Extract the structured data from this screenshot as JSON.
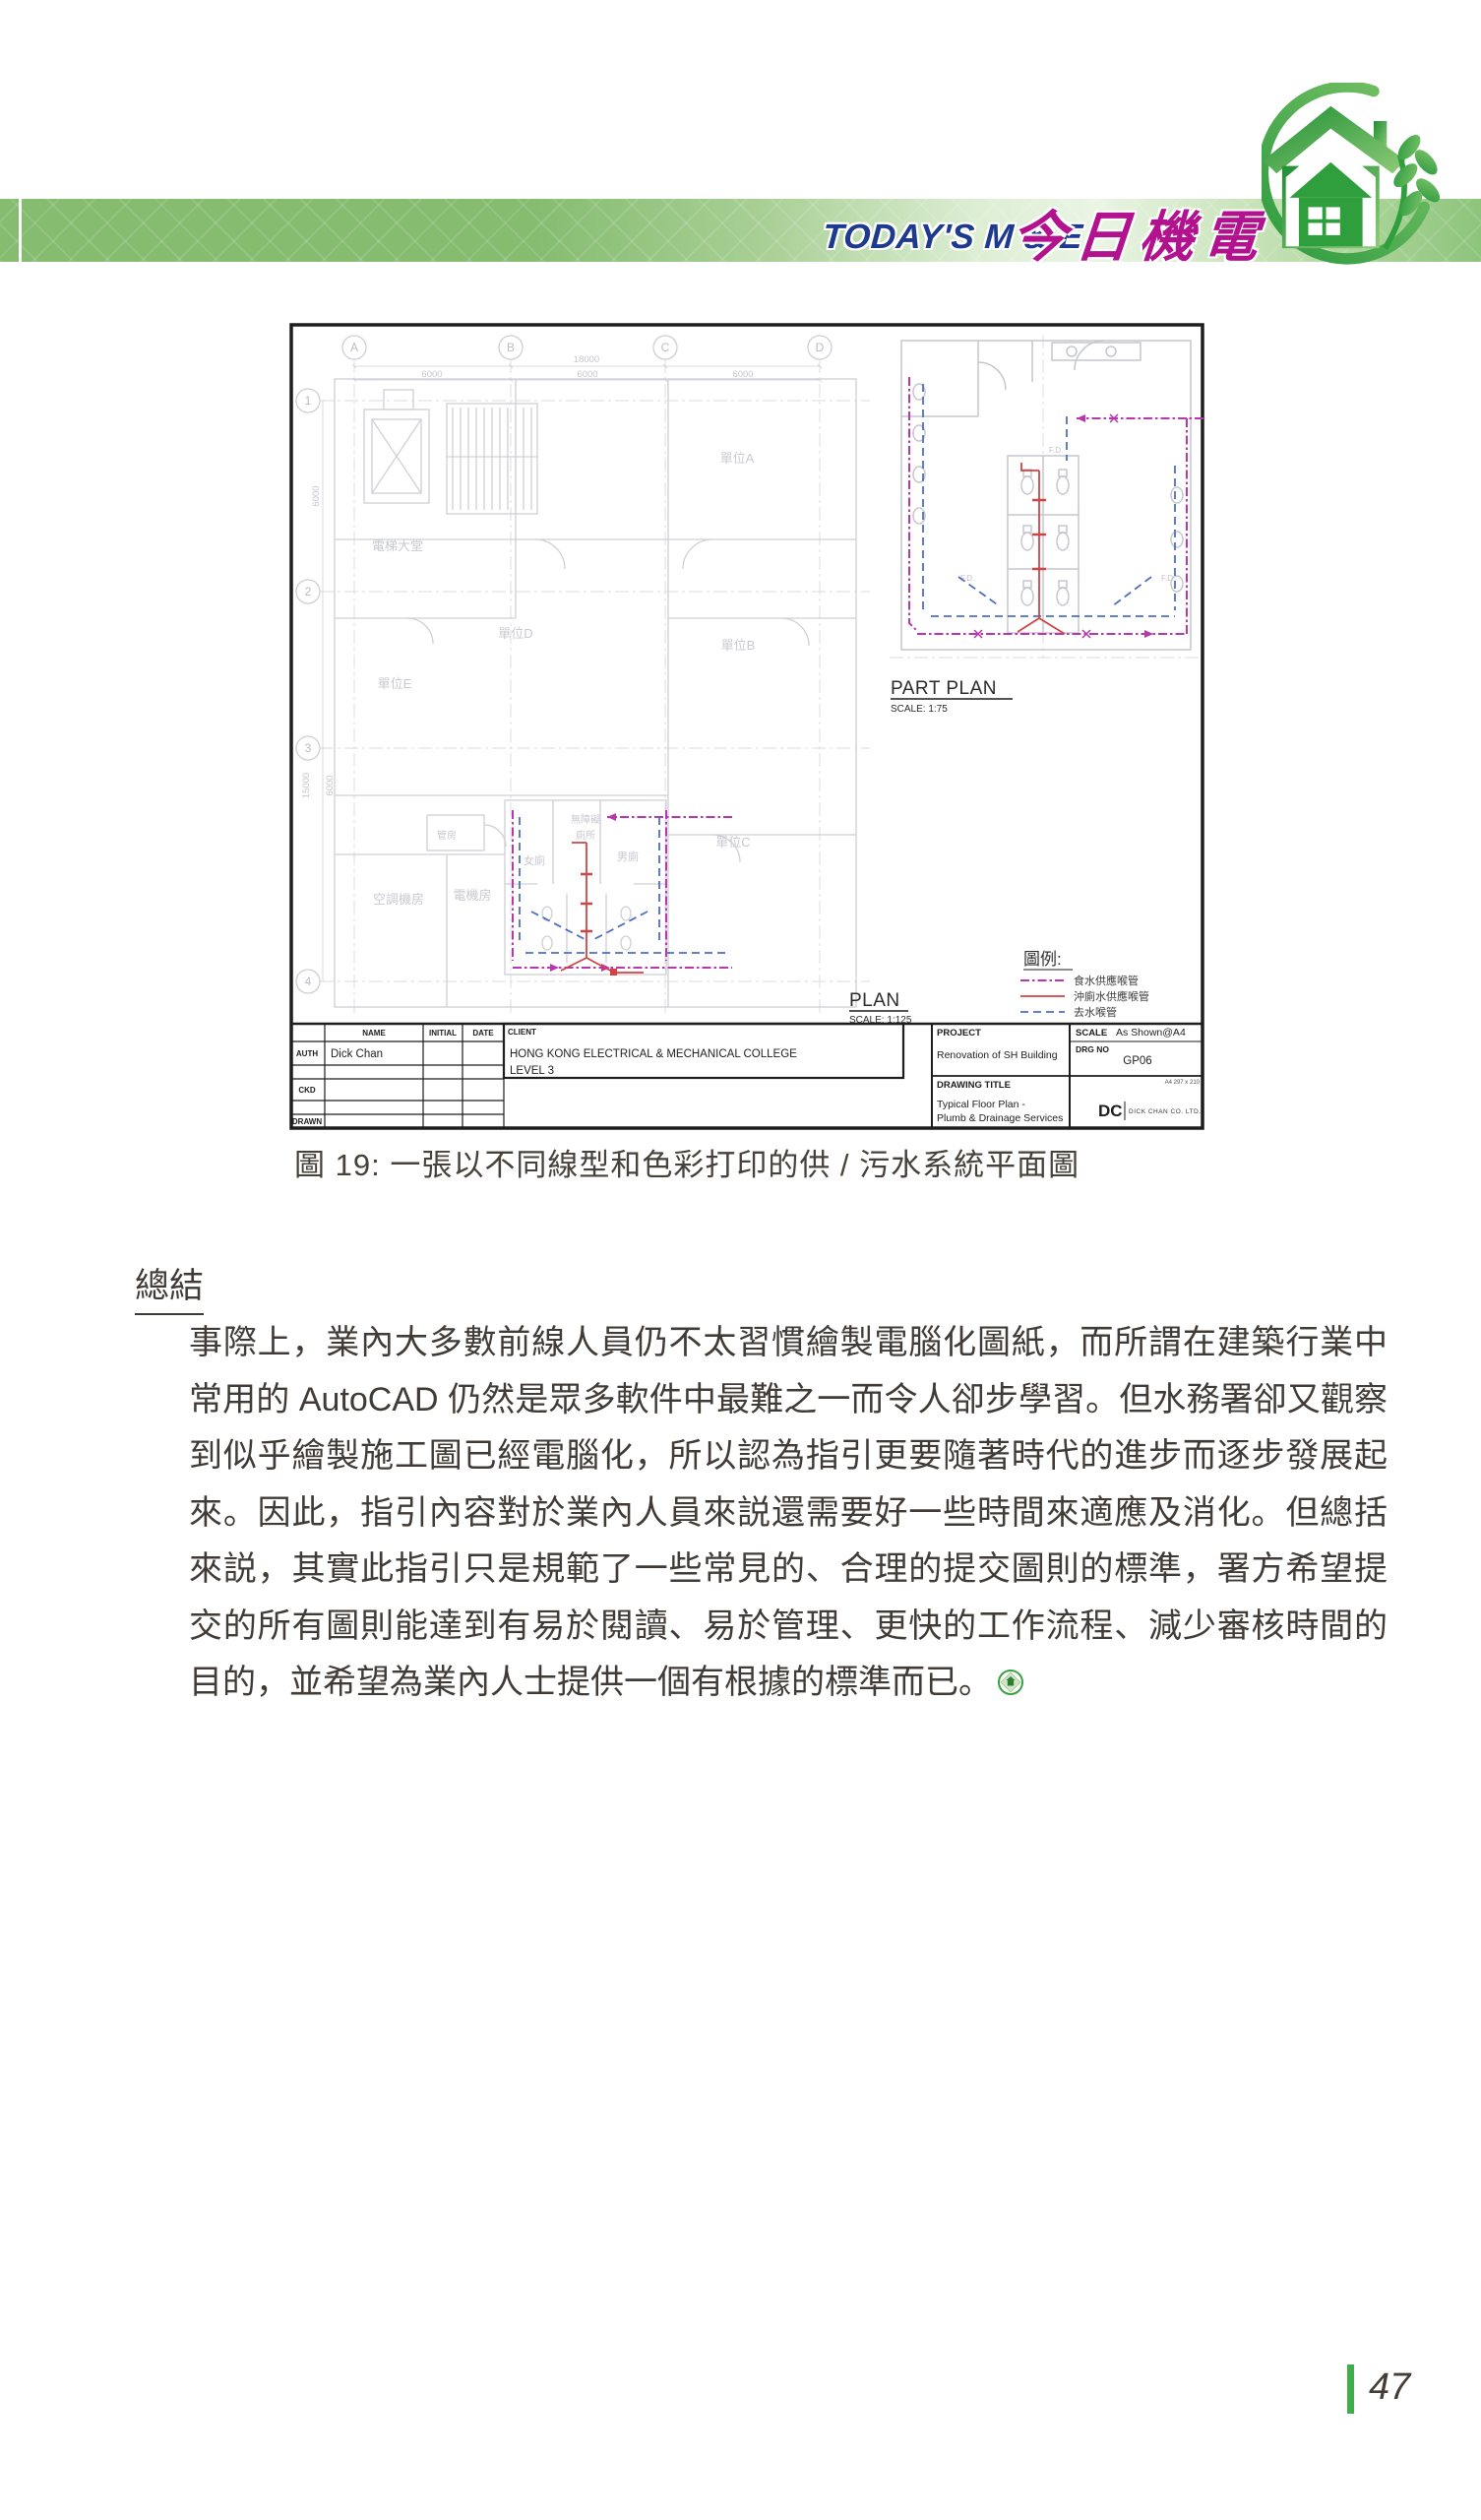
{
  "header": {
    "title_en": "TODAY'S M & E",
    "title_zh": "今日機電"
  },
  "figure": {
    "caption": "圖 19: 一張以不同線型和色彩打印的供 / 污水系統平面圖",
    "drawing": {
      "grid_cols": [
        "A",
        "B",
        "C",
        "D"
      ],
      "grid_rows": [
        "1",
        "2",
        "3",
        "4"
      ],
      "dim_total": "18000",
      "dim_bay": "6000",
      "dim_side_total": "15000",
      "dim_side_bay": "6000",
      "rooms": {
        "unit_a": "單位A",
        "unit_b": "單位B",
        "unit_c": "單位C",
        "unit_d": "單位D",
        "unit_e": "單位E",
        "lift_lobby": "電梯大堂",
        "ac_plant_room": "空調機房",
        "elec_room": "電機房",
        "duct_room": "管房",
        "female_toilet": "女廁",
        "male_toilet": "男廁",
        "accessible_toilet_line1": "無障礙",
        "accessible_toilet_line2": "廁所",
        "floor_drain": "F.D."
      },
      "part_plan": {
        "title": "PART PLAN",
        "scale": "SCALE: 1:75"
      },
      "plan": {
        "title": "PLAN",
        "scale": "SCALE: 1:125"
      },
      "legend": {
        "title": "圖例:",
        "items": [
          {
            "label": "食水供應喉管",
            "color": "#b836ae",
            "line_style": "dash-dot"
          },
          {
            "label": "沖廁水供應喉管",
            "color": "#cf4543",
            "line_style": "solid"
          },
          {
            "label": "去水喉管",
            "color": "#4e6fc0",
            "line_style": "dashed"
          }
        ]
      },
      "title_block": {
        "name_header": "NAME",
        "initial_header": "INITIAL",
        "date_header": "DATE",
        "client_header": "CLIENT",
        "auth_label": "AUTH",
        "ckd_label": "CKD",
        "drawn_label": "DRAWN",
        "auth_name": "Dick Chan",
        "client_line1": "HONG KONG ELECTRICAL & MECHANICAL COLLEGE",
        "client_line2": "LEVEL 3",
        "project_header": "PROJECT",
        "project": "Renovation of SH Building",
        "scale_header": "SCALE",
        "scale_value": "As Shown@A4",
        "drg_no_header": "DRG  NO",
        "drg_no": "GP06",
        "drawing_title_header": "DRAWING  TITLE",
        "drawing_title_line1": "Typical Floor Plan -",
        "drawing_title_line2": "Plumb & Drainage Services",
        "paper_size": "A4 297 x 210",
        "company_mark": "DC",
        "company_name": "DICK CHAN CO. LTD."
      }
    }
  },
  "summary": {
    "heading": "總結",
    "body": "事際上，業內大多數前線人員仍不太習慣繪製電腦化圖紙，而所謂在建築行業中常用的 AutoCAD 仍然是眾多軟件中最難之一而令人卻步學習。但水務署卻又觀察到似乎繪製施工圖已經電腦化，所以認為指引更要隨著時代的進步而逐步發展起來。因此，指引內容對於業內人員來説還需要好一些時間來適應及消化。但總括來説，其實此指引只是規範了一些常見的、合理的提交圖則的標準，署方希望提交的所有圖則能達到有易於閱讀、易於管理、更快的工作流程、減少審核時間的目的，並希望為業內人士提供一個有根據的標準而已。"
  },
  "footer": {
    "page_number": "47"
  },
  "colors": {
    "header_green": "#85bc70",
    "title_en_blue": "#1e3a8f",
    "title_zh_magenta": "#b3128f",
    "logo_green": "#2f9e3c",
    "pipe_fresh_water": "#b836ae",
    "pipe_flush_water": "#cf4543",
    "pipe_drain": "#4e6fc0",
    "footer_bar_green": "#3fae4a"
  }
}
